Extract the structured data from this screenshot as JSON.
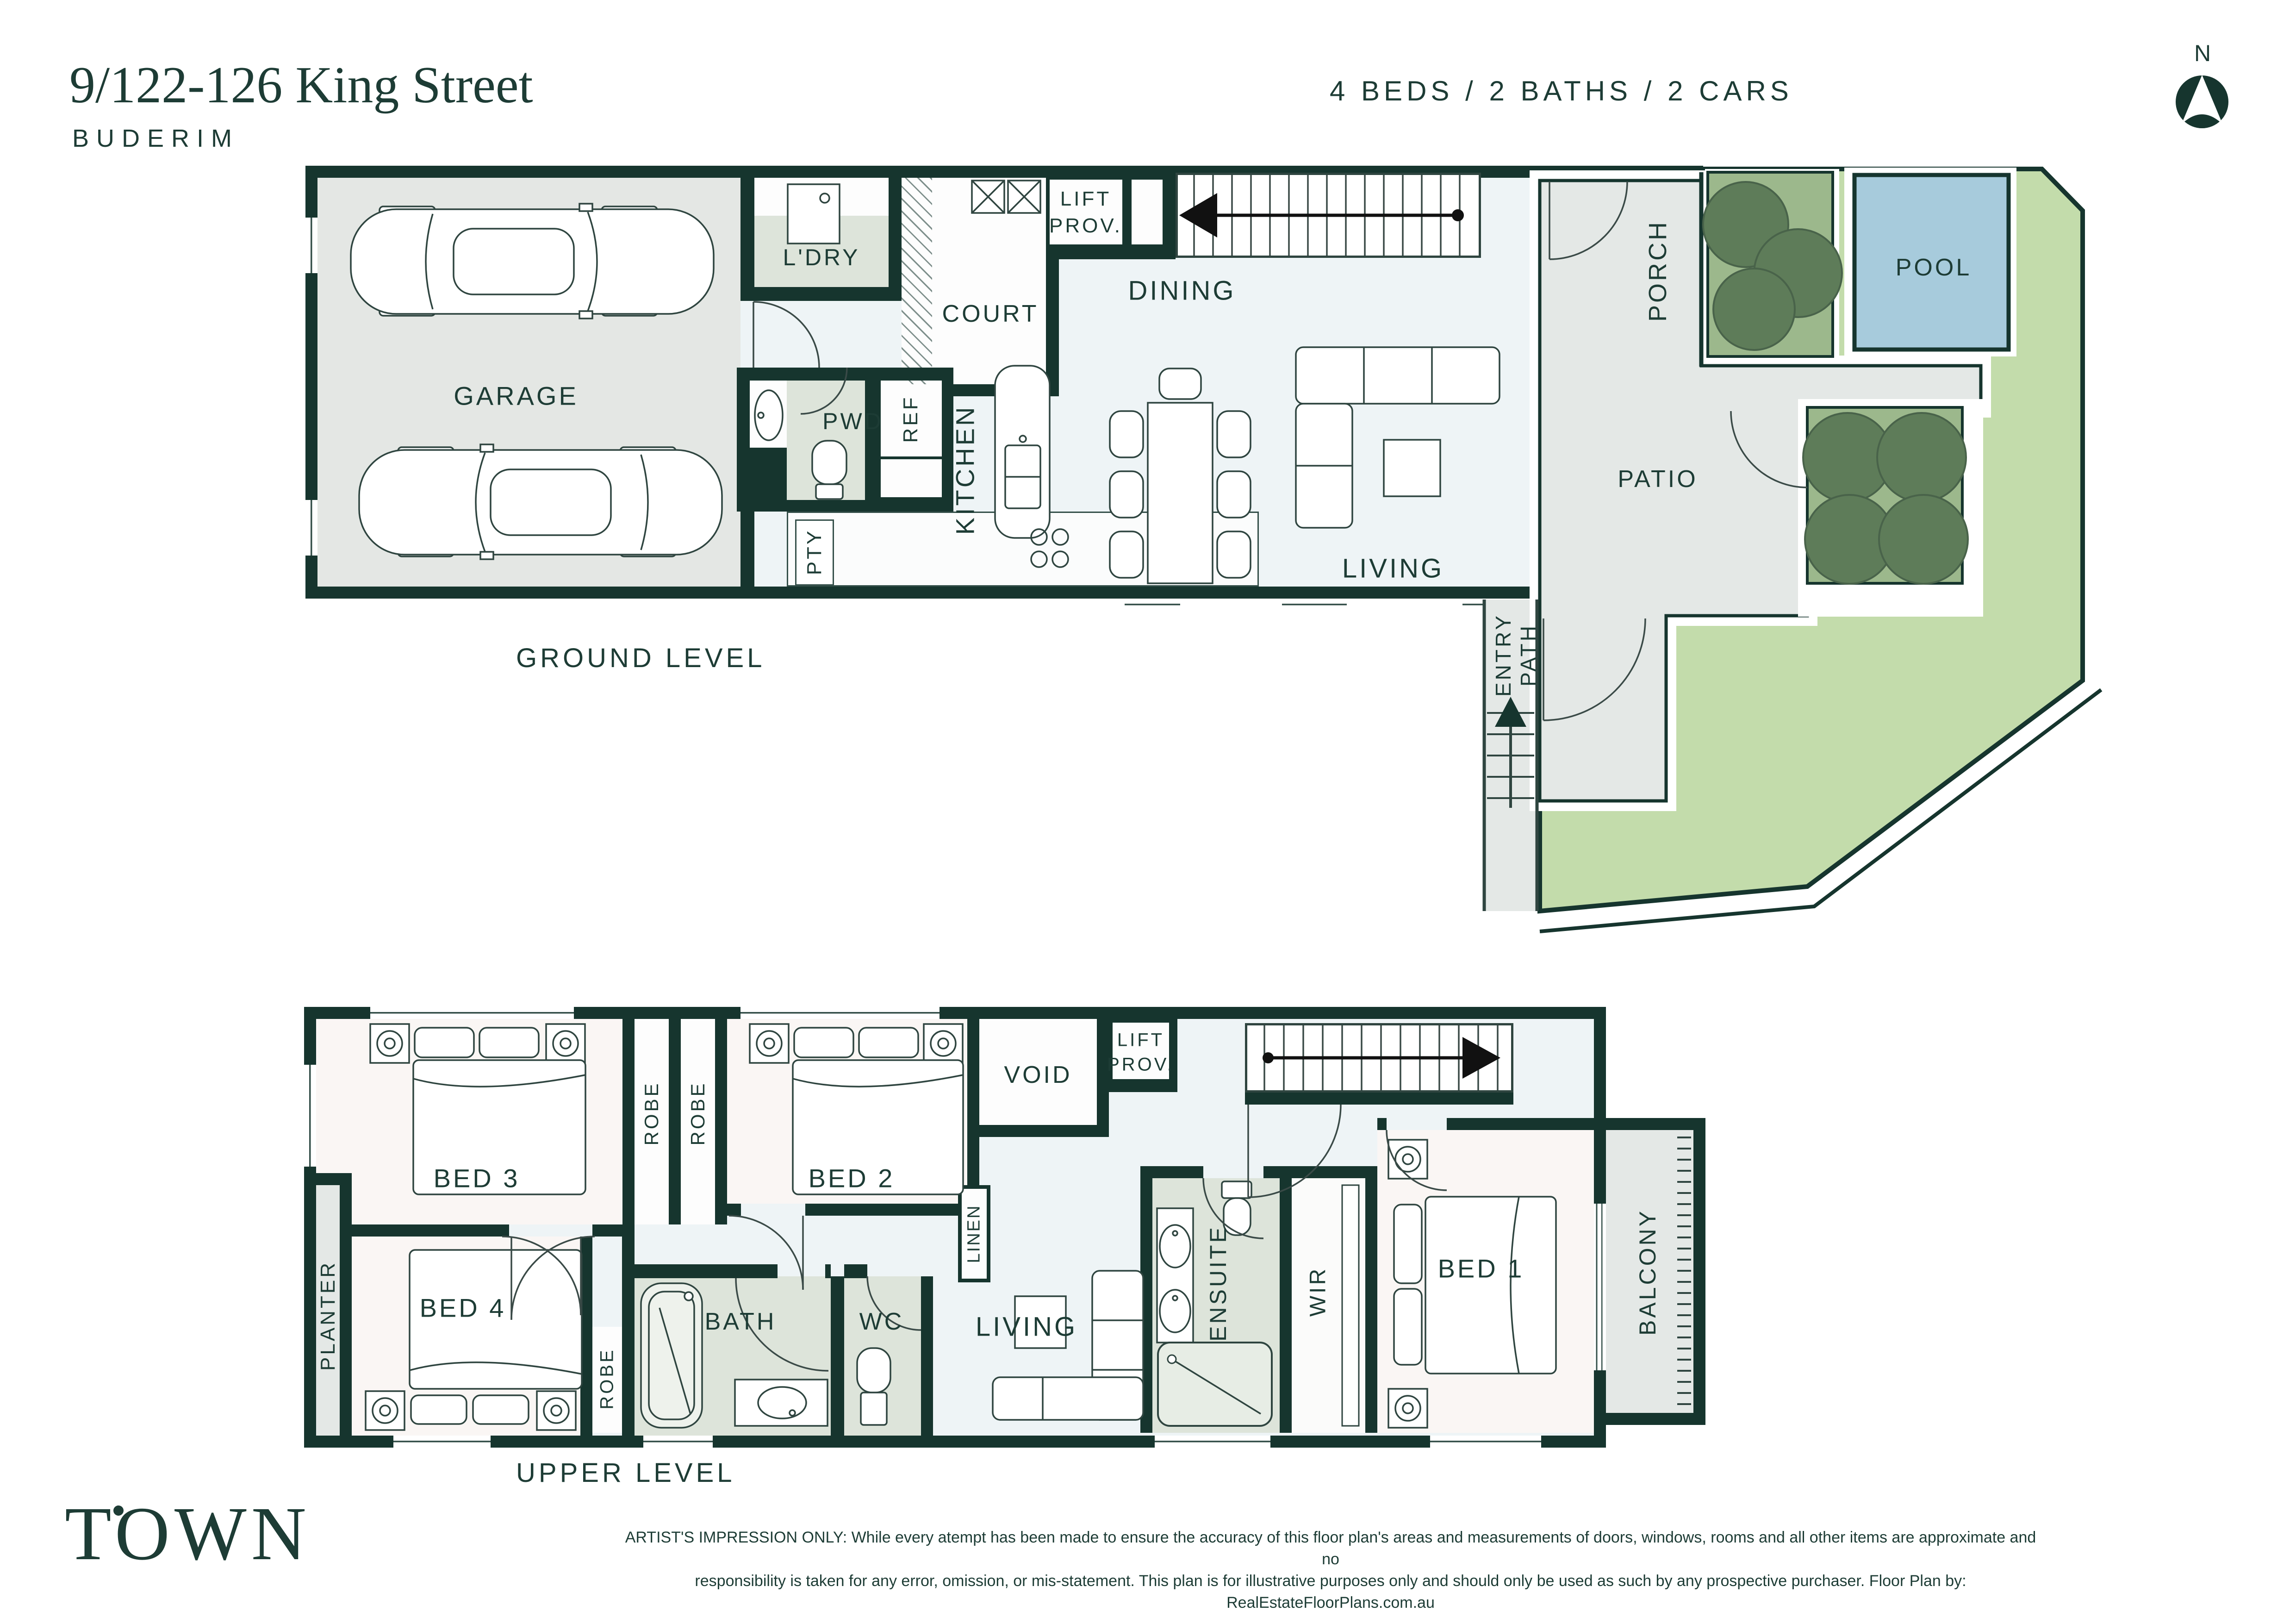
{
  "header": {
    "title": "9/122-126 King Street",
    "suburb": "BUDERIM",
    "summary": "4 BEDS / 2 BATHS / 2 CARS",
    "north": "N"
  },
  "ground": {
    "label": "GROUND LEVEL",
    "garage": "GARAGE",
    "ldry": "L'DRY",
    "court": "COURT",
    "lift1": "LIFT",
    "lift2": "PROV.",
    "dining": "DINING",
    "pwd": "PWD",
    "ref": "REF",
    "kitchen": "KITCHEN",
    "pty": "PTY",
    "living": "LIVING",
    "porch": "PORCH",
    "pool": "POOL",
    "patio": "PATIO",
    "entry": "ENTRY",
    "path": "PATH"
  },
  "upper": {
    "label": "UPPER LEVEL",
    "bed3": "BED 3",
    "robe_a": "ROBE",
    "robe_b": "ROBE",
    "bed2": "BED 2",
    "void": "VOID",
    "lift1": "LIFT",
    "lift2": "PROV.",
    "linen": "LINEN",
    "planter": "PLANTER",
    "bed4": "BED 4",
    "robe_c": "ROBE",
    "bath": "BATH",
    "wc": "WC",
    "living": "LIVING",
    "ensuite": "ENSUITE",
    "wir": "WIR",
    "bed1": "BED 1",
    "balcony": "BALCONY"
  },
  "footer": {
    "logo": "TOWN",
    "disclaimer1": "ARTIST'S IMPRESSION ONLY: While every atempt has been made to ensure the accuracy of this floor plan's areas and measurements of doors, windows, rooms and all other items are approximate and no",
    "disclaimer2": "responsibility is taken for any error, omission, or mis-statement. This plan is for illustrative purposes only and should only be used as such by any prospective purchaser. Floor Plan by: RealEstateFloorPlans.com.au"
  },
  "colors": {
    "wall": "#16352e",
    "ink": "#1d3c35",
    "hall": "#eef4f6",
    "bedroom": "#faf6f4",
    "wet": "#dde4da",
    "garage": "#e4e7e4",
    "outdoor": "#e4e8e6",
    "pool": "#a7cbdc",
    "lawn": "#c3dcab",
    "gardenbed": "#9cb88c",
    "tree": "#5e7c59",
    "line": "#35504a"
  }
}
